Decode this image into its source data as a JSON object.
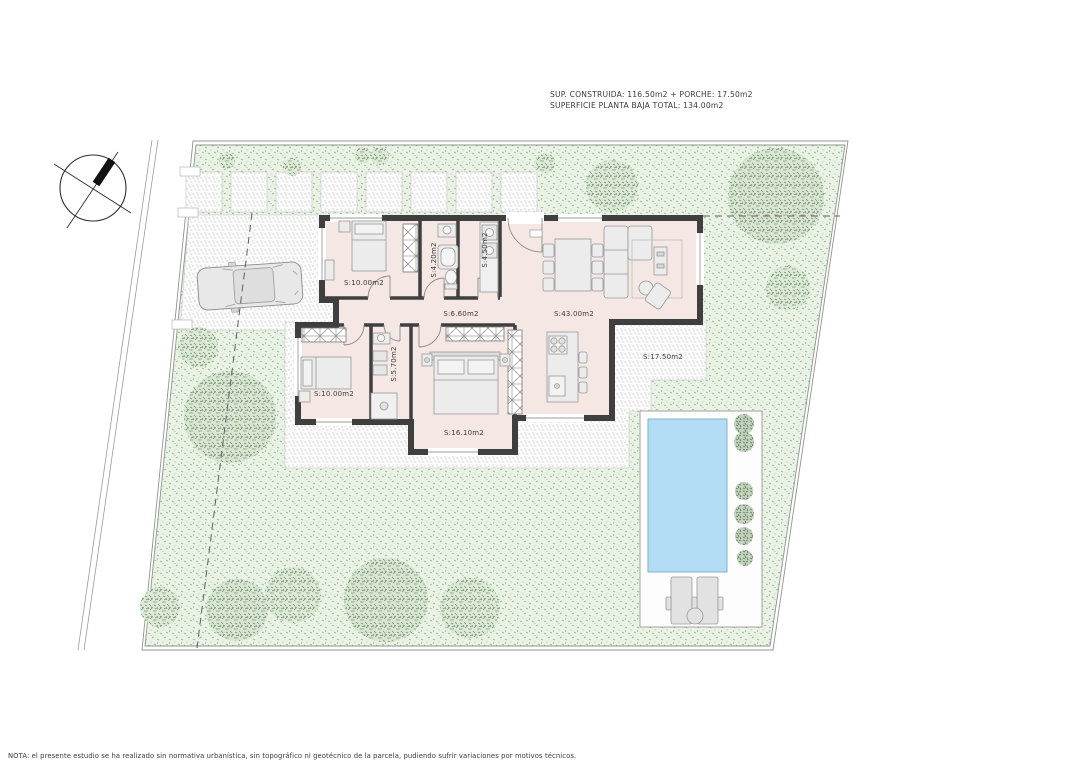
{
  "title_block": {
    "line1": "SUP. CONSTRUIDA: 116.50m2 + PORCHE: 17.50m2",
    "line2": "SUPERFICIE PLANTA BAJA TOTAL: 134.00m2"
  },
  "footer": {
    "note": "NOTA: el presente estudio se ha realizado sin normativa urbanística, sin topográfico ni geotécnico de la parcela, pudiendo sufrir variaciones por motivos técnicos."
  },
  "rooms": [
    {
      "name": "bedroom-1",
      "label": "S:10.00m2"
    },
    {
      "name": "bathroom-1",
      "label": "S:4.20m2"
    },
    {
      "name": "storage",
      "label": "S:4.50m2"
    },
    {
      "name": "hallway",
      "label": "S:6.60m2"
    },
    {
      "name": "living-dining-kitchen",
      "label": "S:43.00m2"
    },
    {
      "name": "porch",
      "label": "S:17.50m2"
    },
    {
      "name": "bedroom-2",
      "label": "S:10.00m2"
    },
    {
      "name": "bathroom-2",
      "label": "S:5.70m2"
    },
    {
      "name": "bedroom-3",
      "label": "S:16.10m2"
    }
  ],
  "icons": {
    "compass": "north-arrow-icon"
  },
  "colors": {
    "lawn": "#e9f2e5",
    "lawn_speck": "#8fb087",
    "terrace": "#fbfbfb",
    "floor": "#f5e8e4",
    "wall": "#3f3f3f",
    "pool_water": "#b3ddf4",
    "tree": "#7d977a"
  }
}
